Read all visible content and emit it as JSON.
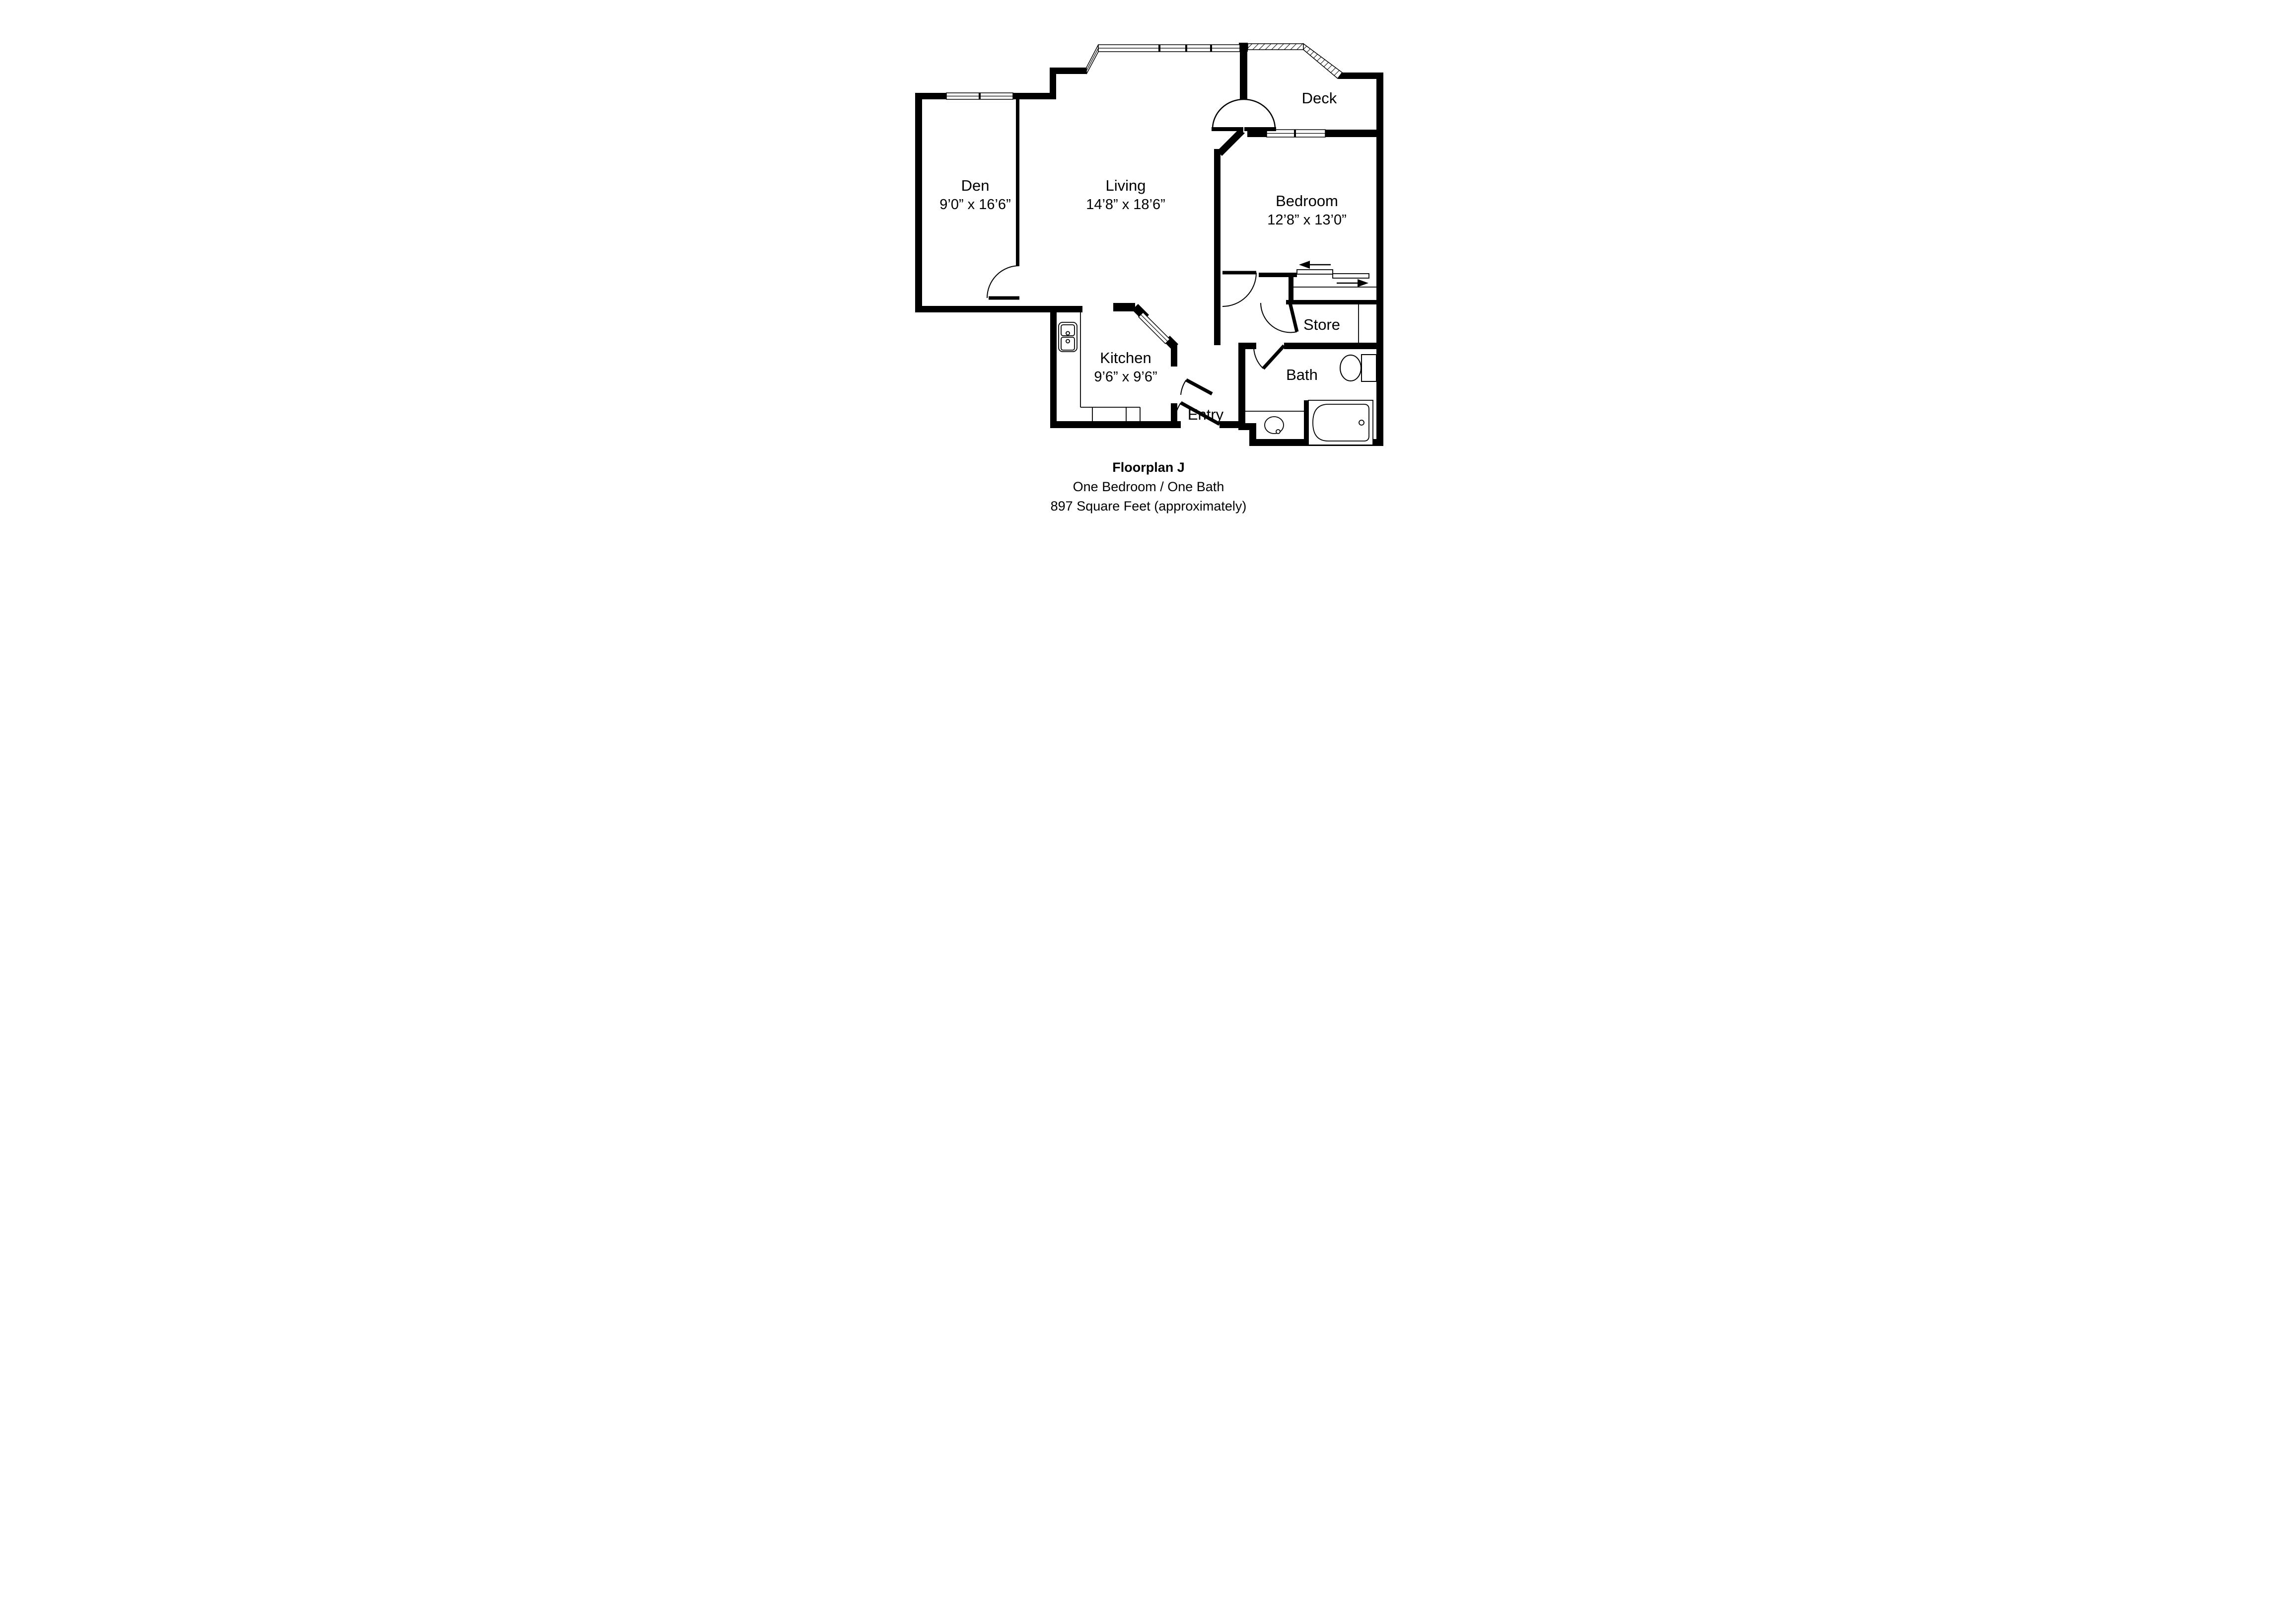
{
  "floorplan": {
    "rooms": {
      "den": {
        "name": "Den",
        "dimensions": "9’0” x 16’6”"
      },
      "living": {
        "name": "Living",
        "dimensions": "14’8” x 18’6”"
      },
      "bedroom": {
        "name": "Bedroom",
        "dimensions": "12’8” x 13’0”"
      },
      "kitchen": {
        "name": "Kitchen",
        "dimensions": "9’6” x 9’6”"
      },
      "deck": {
        "name": "Deck"
      },
      "store": {
        "name": "Store"
      },
      "bath": {
        "name": "Bath"
      },
      "entry": {
        "name": "Entry"
      }
    },
    "caption": {
      "title": "Floorplan J",
      "line2": "One Bedroom / One Bath",
      "line3": "897 Square Feet (approximately)"
    },
    "fixtures": {
      "kitchen_sink": "double-bowl-kitchen-sink",
      "vanity_sink": "oval-vanity-sink",
      "toilet": "toilet",
      "bathtub": "bathtub",
      "closet": "sliding-bypass-closet-doors",
      "balcony_door": "arched-balcony-door-swing"
    },
    "colors": {
      "wall": "#000000",
      "background": "#ffffff"
    }
  }
}
